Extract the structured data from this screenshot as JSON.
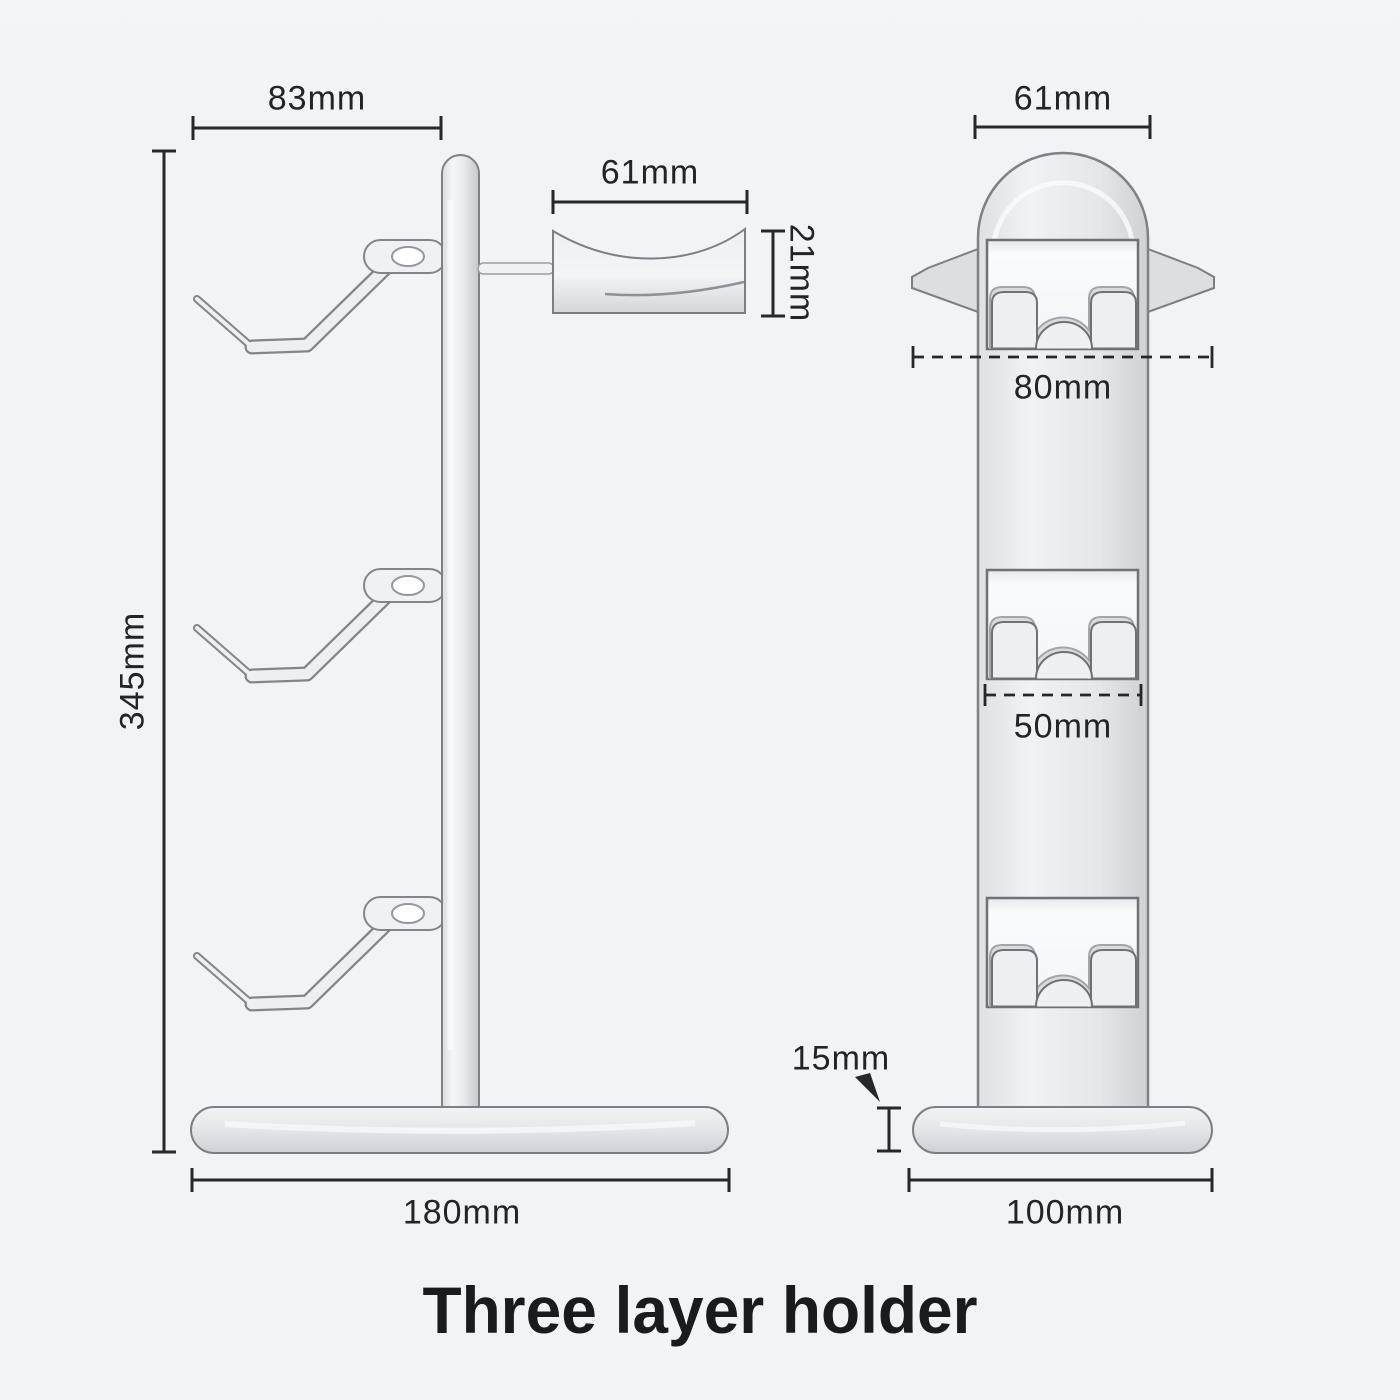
{
  "title": "Three layer holder",
  "views": {
    "side": {
      "label": "side-view",
      "dims": {
        "hook_depth": "83mm",
        "rest_width": "61mm",
        "rest_height": "21mm",
        "total_height": "345mm",
        "base_length": "180mm"
      }
    },
    "front": {
      "label": "front-view",
      "dims": {
        "head_width": "61mm",
        "hook_outer_span": "80mm",
        "hook_inner_span": "50mm",
        "base_thickness": "15mm",
        "base_width": "100mm"
      }
    }
  },
  "colors": {
    "background": "#f1f3f6",
    "product_fill": "#e9ebee",
    "product_highlight": "#f7f8fa",
    "product_shadow": "#c9ccd0",
    "product_outline": "#7e8186",
    "dimension_line": "#25272b",
    "label_text": "#222428",
    "title_text": "#1a1b1e"
  }
}
